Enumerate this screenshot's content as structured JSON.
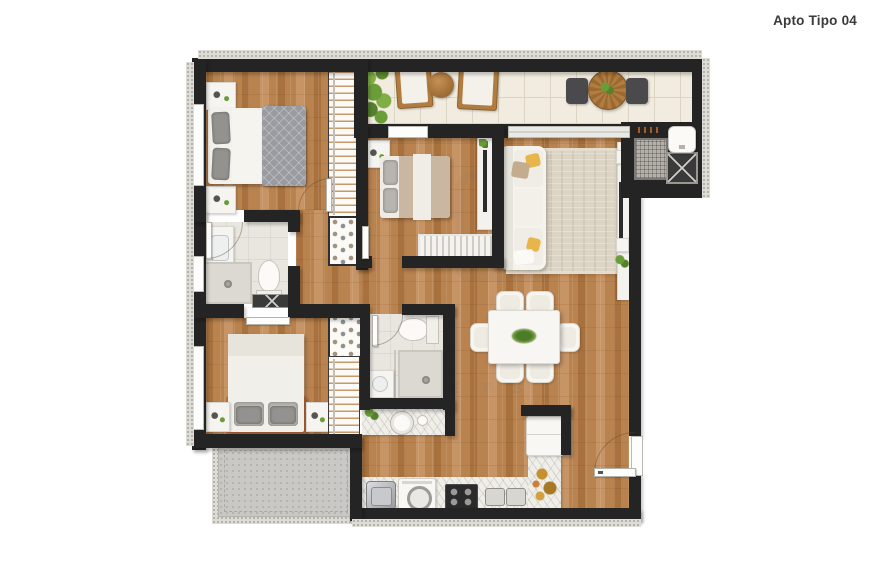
{
  "header": {
    "title": "Apto Tipo 04"
  },
  "watermark": {
    "letters": "E T S"
  },
  "colors": {
    "wall": "#242424",
    "wood": "#b9834f",
    "woodDark": "#a8713d",
    "woodLight": "#c79465",
    "tile": "#f1ecdf",
    "tileLine": "#ddd5c3",
    "bathTile": "#e9e6e0",
    "marble": "#f0eee8",
    "grayext": "#c9c8c4",
    "rug": "#dcd4c4",
    "terracotta": "#c06a3c",
    "plant": "#6f9d3a",
    "white": "#f6f4f0",
    "metal": "#b9babc",
    "gold": "#c3912f",
    "accentYellow": "#e8b54a"
  }
}
